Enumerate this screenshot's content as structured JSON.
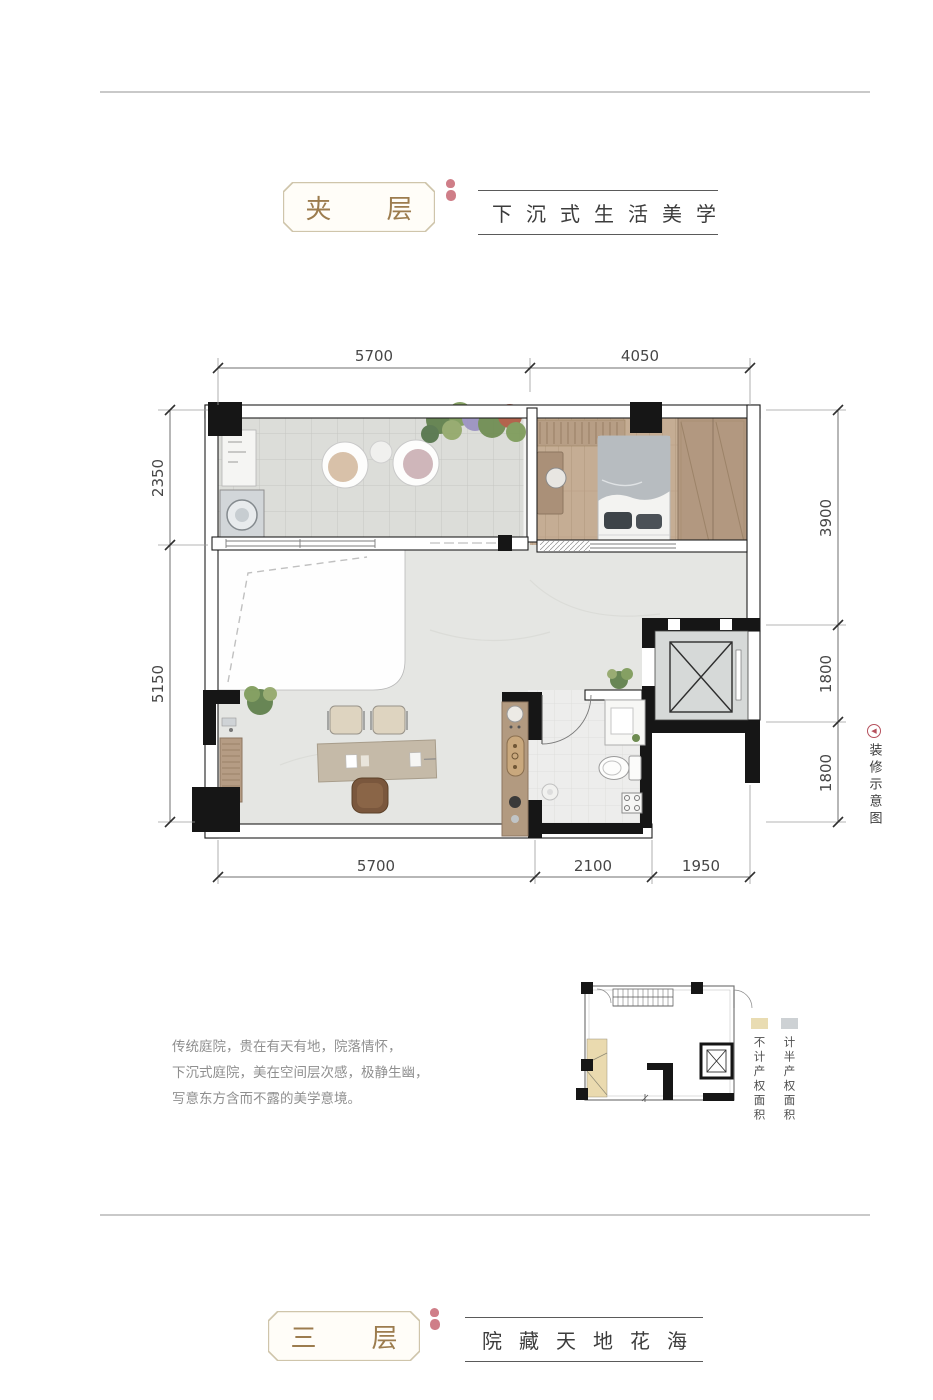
{
  "header_top": {
    "box_label": "夹层",
    "subtitle": "下沉式生活美学"
  },
  "header_bottom": {
    "box_label": "三层",
    "subtitle": "院藏天地花海"
  },
  "description": {
    "lines": [
      "传统庭院，贵在有天有地，院落情怀，",
      "下沉式庭院，美在空间层次感，极静生幽，",
      "写意东方含而不露的美学意境。"
    ]
  },
  "side_note": {
    "label": "装修示意图"
  },
  "plan": {
    "dims": {
      "top": [
        "5700",
        "4050"
      ],
      "bottom": [
        "5700",
        "2100",
        "1950"
      ],
      "left": [
        "2350",
        "5150"
      ],
      "right": [
        "3900",
        "1800",
        "1800"
      ]
    }
  },
  "legend": {
    "items": [
      {
        "label": "不计产权面积",
        "color": "#e9dcb2"
      },
      {
        "label": "计半产权面积",
        "color": "#cdd1d4"
      }
    ]
  },
  "colors": {
    "accent_gold": "#9c7c4e",
    "seal_red": "#bf5360",
    "wall_black": "#161616",
    "wood": "#b29880",
    "terrace_floor": "#dcddd9",
    "bedroom_floor": "#c5ad94",
    "living_floor": "#e5e6e3",
    "elevator_fill": "#d6d9d8"
  }
}
